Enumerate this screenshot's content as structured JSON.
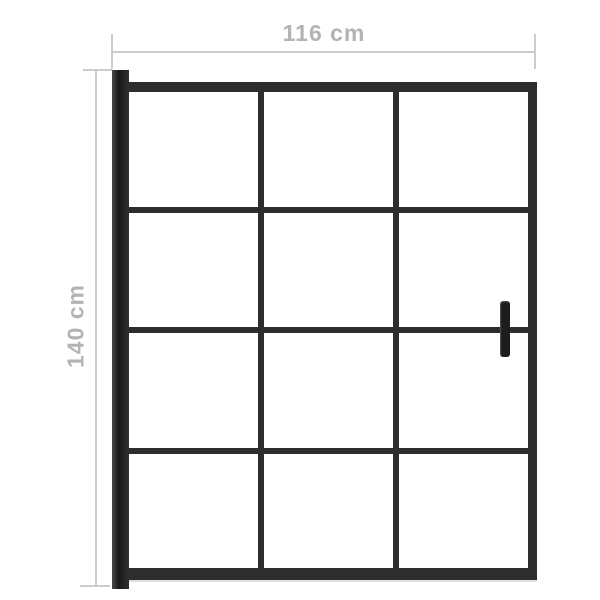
{
  "diagram": {
    "type": "product-dimension-diagram",
    "subject": "shower screen with wall profile, 3x4 glass pane grid and handle",
    "width_label": "116 cm",
    "height_label": "140 cm",
    "grid": {
      "columns": 3,
      "rows": 4
    },
    "colors": {
      "background": "#ffffff",
      "frame": "#2d2d2d",
      "pane": "#ffffff",
      "dimension_line": "#cccccc",
      "dimension_text": "#b3b3b3",
      "handle": "#1d1d1d"
    }
  }
}
